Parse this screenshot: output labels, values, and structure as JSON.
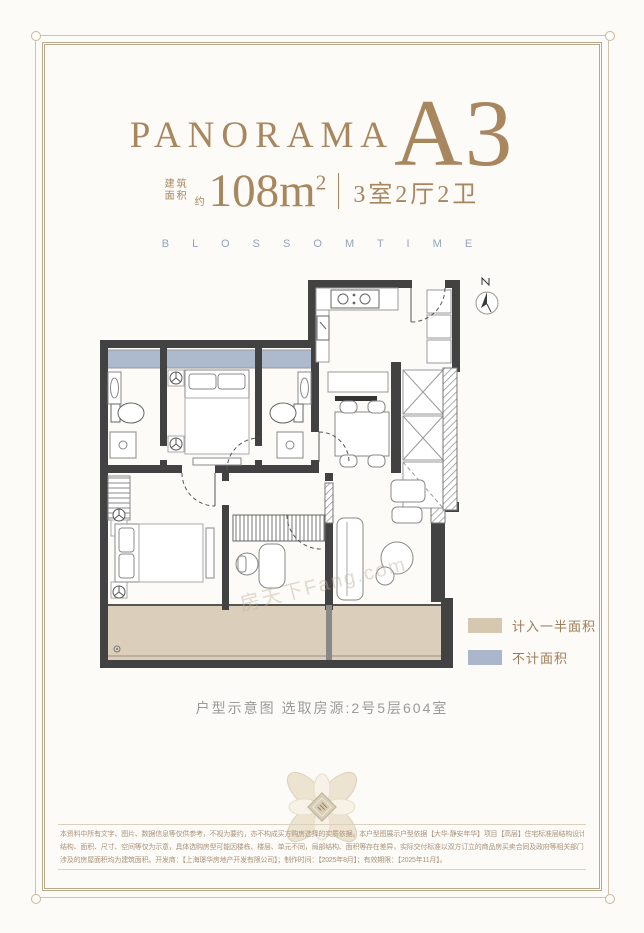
{
  "header": {
    "brand": "PANORAMA",
    "unit_code": "A3",
    "area_label_line1": "建筑",
    "area_label_line2": "面积",
    "area_approx": "约",
    "area_value": "108m",
    "area_exponent": "2",
    "layout": "3室2厅2卫",
    "tagline": "B L O S S O M   T I M E"
  },
  "plan": {
    "watermark": "房天下Fang.com"
  },
  "legend": {
    "items": [
      {
        "label": "计入一半面积",
        "color": "#d6c7b0"
      },
      {
        "label": "不计面积",
        "color": "#a9b6cc"
      }
    ]
  },
  "caption": "户型示意图 选取房源:2号5层604室",
  "footer": {
    "disclaimer_line1": "本资料中所有文字、图片、数据信息等仅供参考，不视为要约，亦不构成买方购房选择的实质依据。本户型图展示户型依据【大华·静安年华】项目【高层】住宅标准层结构设计，本资料所示",
    "disclaimer_line2": "结构、面积、尺寸、空间等仅为示意，具体选购房型可能因楼栋、楼层、单元不同，局部结构、面积等存在差异，实际交付标准以双方订立的商品房买卖合同及政府等相关部门的批准文件为准，",
    "disclaimer_line3": "涉及的房屋面积均为建筑面积。开发商：【上海璟华房地产开发有限公司】；制作时间：【2025年8月】；有效期限：【2025年11月】。"
  },
  "colors": {
    "accent_gold": "#a8865e",
    "tagline_blue": "#93a3b8",
    "half_area_tan": "#d6c7b0",
    "excluded_blue": "#a9b6cc",
    "wall_dark": "#424242"
  }
}
